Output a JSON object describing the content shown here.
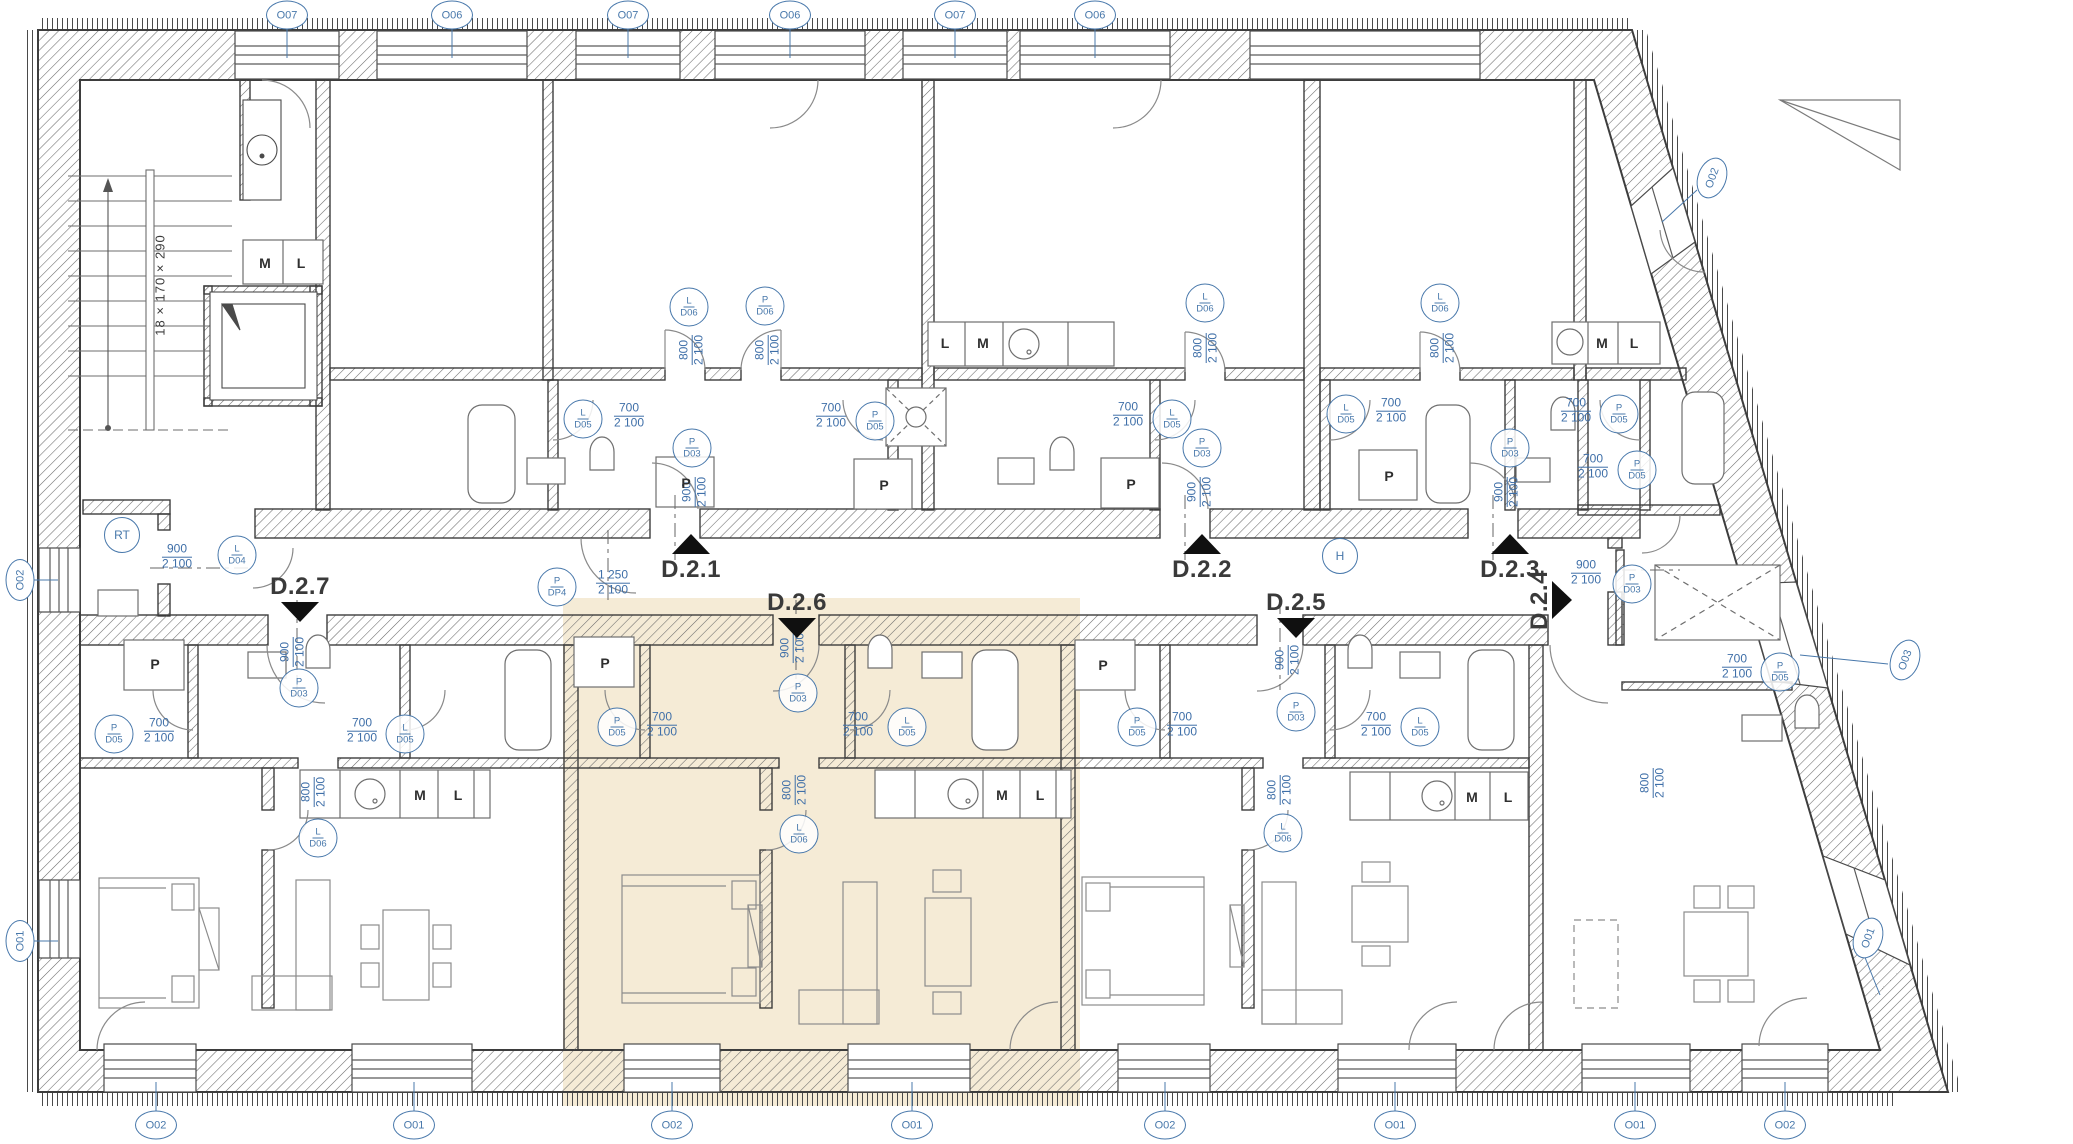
{
  "plan": {
    "highlight_color": "#f5ebd6",
    "tag_color": "#4878ab",
    "wall_color": "#3d3d3d",
    "stair_note": "18 × 170 × 290"
  },
  "apartment_labels": [
    {
      "label": "D.2.1",
      "x": 691,
      "y": 570,
      "dir": "up"
    },
    {
      "label": "D.2.2",
      "x": 1202,
      "y": 570,
      "dir": "up"
    },
    {
      "label": "D.2.3",
      "x": 1510,
      "y": 570,
      "dir": "up"
    },
    {
      "label": "D.2.7",
      "x": 300,
      "y": 587,
      "dir": "down"
    },
    {
      "label": "D.2.6",
      "x": 797,
      "y": 603,
      "dir": "down"
    },
    {
      "label": "D.2.5",
      "x": 1296,
      "y": 603,
      "dir": "down"
    },
    {
      "label": "D.2.4",
      "x": 1540,
      "y": 600,
      "dir": "right"
    }
  ],
  "window_tags": [
    {
      "label": "O07",
      "x": 287,
      "y": 15,
      "rot": 0
    },
    {
      "label": "O06",
      "x": 452,
      "y": 15,
      "rot": 0
    },
    {
      "label": "O07",
      "x": 628,
      "y": 15,
      "rot": 0
    },
    {
      "label": "O06",
      "x": 790,
      "y": 15,
      "rot": 0
    },
    {
      "label": "O07",
      "x": 955,
      "y": 15,
      "rot": 0
    },
    {
      "label": "O06",
      "x": 1095,
      "y": 15,
      "rot": 0
    },
    {
      "label": "O02",
      "x": 20,
      "y": 580,
      "rot": -90
    },
    {
      "label": "O01",
      "x": 20,
      "y": 941,
      "rot": -90
    },
    {
      "label": "O02",
      "x": 156,
      "y": 1125,
      "rot": 0
    },
    {
      "label": "O01",
      "x": 414,
      "y": 1125,
      "rot": 0
    },
    {
      "label": "O02",
      "x": 672,
      "y": 1125,
      "rot": 0
    },
    {
      "label": "O01",
      "x": 912,
      "y": 1125,
      "rot": 0
    },
    {
      "label": "O02",
      "x": 1165,
      "y": 1125,
      "rot": 0
    },
    {
      "label": "O01",
      "x": 1395,
      "y": 1125,
      "rot": 0
    },
    {
      "label": "O01",
      "x": 1635,
      "y": 1125,
      "rot": 0
    },
    {
      "label": "O02",
      "x": 1785,
      "y": 1125,
      "rot": 0
    },
    {
      "label": "O02",
      "x": 1712,
      "y": 178,
      "rot": -70
    },
    {
      "label": "O03",
      "x": 1905,
      "y": 660,
      "rot": -70
    },
    {
      "label": "O01",
      "x": 1868,
      "y": 938,
      "rot": -70
    }
  ],
  "door_tags": [
    {
      "top": "L",
      "bottom": "D06",
      "x": 689,
      "y": 307
    },
    {
      "top": "P",
      "bottom": "D06",
      "x": 765,
      "y": 306
    },
    {
      "top": "L",
      "bottom": "D06",
      "x": 1205,
      "y": 303
    },
    {
      "top": "L",
      "bottom": "D06",
      "x": 1440,
      "y": 303
    },
    {
      "top": "L",
      "bottom": "D05",
      "x": 583,
      "y": 419
    },
    {
      "top": "P",
      "bottom": "D05",
      "x": 875,
      "y": 421
    },
    {
      "top": "L",
      "bottom": "D05",
      "x": 1172,
      "y": 419
    },
    {
      "top": "L",
      "bottom": "D05",
      "x": 1346,
      "y": 414
    },
    {
      "top": "P",
      "bottom": "D05",
      "x": 1619,
      "y": 414
    },
    {
      "top": "P",
      "bottom": "D03",
      "x": 692,
      "y": 448
    },
    {
      "top": "P",
      "bottom": "D03",
      "x": 1202,
      "y": 448
    },
    {
      "top": "P",
      "bottom": "D03",
      "x": 1510,
      "y": 448
    },
    {
      "top": "P",
      "bottom": "DP4",
      "x": 557,
      "y": 587
    },
    {
      "top": "L",
      "bottom": "D04",
      "x": 237,
      "y": 555
    },
    {
      "top": "P",
      "bottom": "D03",
      "x": 299,
      "y": 688
    },
    {
      "top": "P",
      "bottom": "D03",
      "x": 798,
      "y": 693
    },
    {
      "top": "P",
      "bottom": "D03",
      "x": 1296,
      "y": 712
    },
    {
      "top": "P",
      "bottom": "D03",
      "x": 1632,
      "y": 584
    },
    {
      "top": "P",
      "bottom": "D05",
      "x": 114,
      "y": 734
    },
    {
      "top": "L",
      "bottom": "D05",
      "x": 405,
      "y": 734
    },
    {
      "top": "P",
      "bottom": "D05",
      "x": 617,
      "y": 727
    },
    {
      "top": "L",
      "bottom": "D05",
      "x": 907,
      "y": 727
    },
    {
      "top": "P",
      "bottom": "D05",
      "x": 1137,
      "y": 727
    },
    {
      "top": "L",
      "bottom": "D05",
      "x": 1420,
      "y": 727
    },
    {
      "top": "L",
      "bottom": "D06",
      "x": 318,
      "y": 838
    },
    {
      "top": "L",
      "bottom": "D06",
      "x": 799,
      "y": 834
    },
    {
      "top": "L",
      "bottom": "D06",
      "x": 1283,
      "y": 833
    },
    {
      "top": "P",
      "bottom": "D05",
      "x": 1637,
      "y": 470
    },
    {
      "top": "P",
      "bottom": "D05",
      "x": 1780,
      "y": 672
    }
  ],
  "dimensions": [
    {
      "line1": "800",
      "line2": "2 100",
      "x": 692,
      "y": 350,
      "vertical": true
    },
    {
      "line1": "800",
      "line2": "2 100",
      "x": 768,
      "y": 350,
      "vertical": true
    },
    {
      "line1": "800",
      "line2": "2 100",
      "x": 1206,
      "y": 348,
      "vertical": true
    },
    {
      "line1": "800",
      "line2": "2 100",
      "x": 1443,
      "y": 348,
      "vertical": true
    },
    {
      "line1": "700",
      "line2": "2 100",
      "x": 629,
      "y": 416,
      "vertical": false
    },
    {
      "line1": "700",
      "line2": "2 100",
      "x": 831,
      "y": 416,
      "vertical": false
    },
    {
      "line1": "700",
      "line2": "2 100",
      "x": 1128,
      "y": 415,
      "vertical": false
    },
    {
      "line1": "700",
      "line2": "2 100",
      "x": 1391,
      "y": 411,
      "vertical": false
    },
    {
      "line1": "700",
      "line2": "2 100",
      "x": 1576,
      "y": 411,
      "vertical": false
    },
    {
      "line1": "900",
      "line2": "2 100",
      "x": 695,
      "y": 492,
      "vertical": true
    },
    {
      "line1": "900",
      "line2": "2 100",
      "x": 1200,
      "y": 492,
      "vertical": true
    },
    {
      "line1": "900",
      "line2": "2 100",
      "x": 1507,
      "y": 492,
      "vertical": true
    },
    {
      "line1": "1 250",
      "line2": "2 100",
      "x": 613,
      "y": 583,
      "vertical": false
    },
    {
      "line1": "900",
      "line2": "2 100",
      "x": 177,
      "y": 557,
      "vertical": false
    },
    {
      "line1": "900",
      "line2": "2 100",
      "x": 293,
      "y": 652,
      "vertical": true
    },
    {
      "line1": "900",
      "line2": "2 100",
      "x": 793,
      "y": 648,
      "vertical": true
    },
    {
      "line1": "900",
      "line2": "2 100",
      "x": 1288,
      "y": 660,
      "vertical": true
    },
    {
      "line1": "900",
      "line2": "2 100",
      "x": 1586,
      "y": 573,
      "vertical": false
    },
    {
      "line1": "700",
      "line2": "2 100",
      "x": 159,
      "y": 731,
      "vertical": false
    },
    {
      "line1": "700",
      "line2": "2 100",
      "x": 362,
      "y": 731,
      "vertical": false
    },
    {
      "line1": "700",
      "line2": "2 100",
      "x": 662,
      "y": 725,
      "vertical": false
    },
    {
      "line1": "700",
      "line2": "2 100",
      "x": 858,
      "y": 725,
      "vertical": false
    },
    {
      "line1": "700",
      "line2": "2 100",
      "x": 1182,
      "y": 725,
      "vertical": false
    },
    {
      "line1": "700",
      "line2": "2 100",
      "x": 1376,
      "y": 725,
      "vertical": false
    },
    {
      "line1": "800",
      "line2": "2 100",
      "x": 314,
      "y": 792,
      "vertical": true
    },
    {
      "line1": "800",
      "line2": "2 100",
      "x": 795,
      "y": 790,
      "vertical": true
    },
    {
      "line1": "800",
      "line2": "2 100",
      "x": 1280,
      "y": 790,
      "vertical": true
    },
    {
      "line1": "700",
      "line2": "2 100",
      "x": 1593,
      "y": 467,
      "vertical": false
    },
    {
      "line1": "700",
      "line2": "2 100",
      "x": 1737,
      "y": 667,
      "vertical": false
    },
    {
      "line1": "800",
      "line2": "2 100",
      "x": 1653,
      "y": 783,
      "vertical": true
    }
  ],
  "room_labels": [
    {
      "text": "M",
      "x": 265,
      "y": 263
    },
    {
      "text": "L",
      "x": 301,
      "y": 263
    },
    {
      "text": "L",
      "x": 945,
      "y": 343
    },
    {
      "text": "M",
      "x": 983,
      "y": 343
    },
    {
      "text": "M",
      "x": 1602,
      "y": 343
    },
    {
      "text": "L",
      "x": 1634,
      "y": 343
    },
    {
      "text": "P",
      "x": 686,
      "y": 483
    },
    {
      "text": "P",
      "x": 884,
      "y": 485
    },
    {
      "text": "P",
      "x": 1131,
      "y": 484
    },
    {
      "text": "P",
      "x": 1389,
      "y": 476
    },
    {
      "text": "P",
      "x": 155,
      "y": 664
    },
    {
      "text": "P",
      "x": 605,
      "y": 663
    },
    {
      "text": "P",
      "x": 1103,
      "y": 665
    },
    {
      "text": "M",
      "x": 420,
      "y": 795
    },
    {
      "text": "L",
      "x": 458,
      "y": 795
    },
    {
      "text": "M",
      "x": 1002,
      "y": 795
    },
    {
      "text": "L",
      "x": 1040,
      "y": 795
    },
    {
      "text": "M",
      "x": 1472,
      "y": 797
    },
    {
      "text": "L",
      "x": 1508,
      "y": 797
    }
  ],
  "utility_tags": [
    {
      "text": "RT",
      "x": 122,
      "y": 535
    },
    {
      "text": "H",
      "x": 1340,
      "y": 556
    }
  ]
}
